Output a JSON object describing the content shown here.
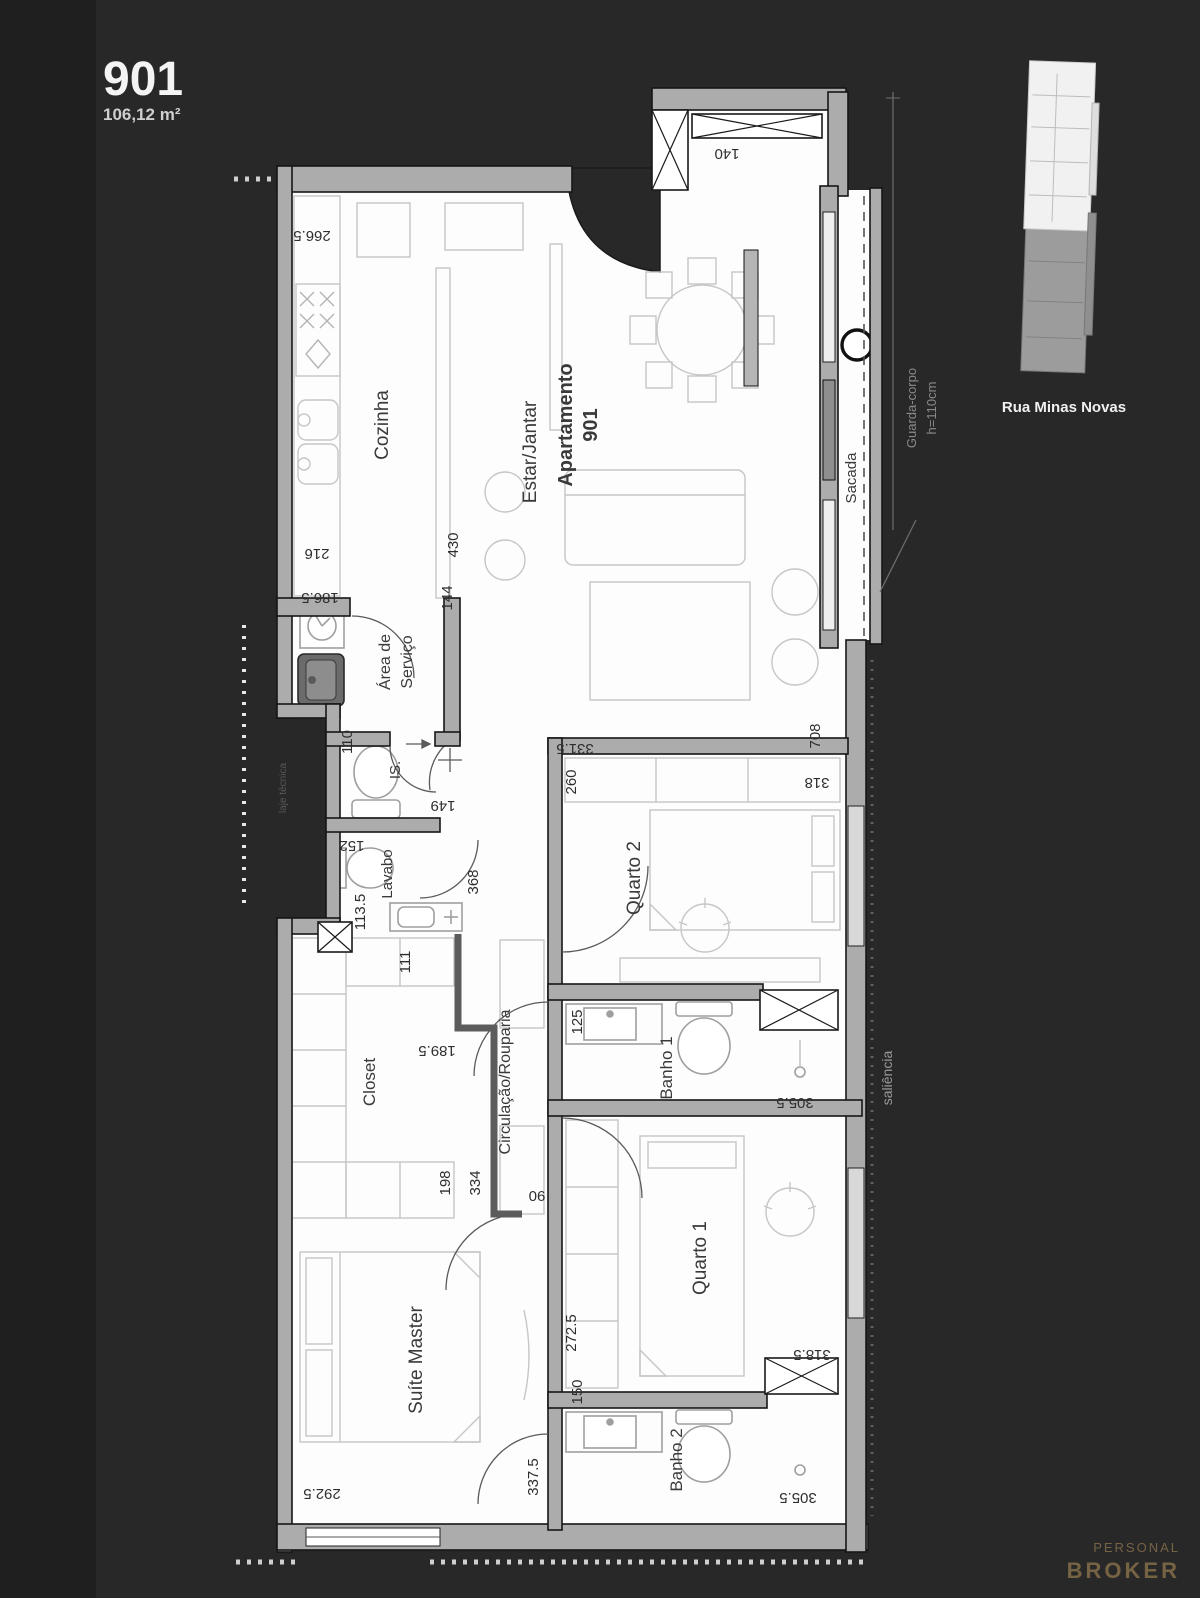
{
  "header": {
    "unit": "901",
    "area": "106,12 m²"
  },
  "minimap": {
    "street": "Rua Minas Novas"
  },
  "logo": {
    "line1": "PERSONAL",
    "line2": "BROKER"
  },
  "plan": {
    "rooms": {
      "cozinha": "Cozinha",
      "estar": "Estar/Jantar",
      "apto_l1": "Apartamento",
      "apto_l2": "901",
      "servico_l1": "Área de",
      "servico_l2": "Serviço",
      "is": "IS.",
      "lavabo": "Lavabo",
      "closet": "Closet",
      "circulacao": "Circulação/Rouparia",
      "quarto2": "Quarto 2",
      "banho1": "Banho 1",
      "quarto1": "Quarto 1",
      "banho2": "Banho 2",
      "suite": "Suíte Master",
      "sacada": "Sacada",
      "saliencia": "saliência",
      "guarda_l1": "Guarda-corpo",
      "guarda_l2": "h=110cm",
      "laje": "laje técnica"
    },
    "dims": {
      "d266_5": "266.5",
      "d140": "140",
      "d216": "216",
      "d186_5": "186.5",
      "d430": "430",
      "d144": "144",
      "d110": "110",
      "d149": "149",
      "d152": "152",
      "d113_5": "113.5",
      "d368": "368",
      "d111": "111",
      "d189_5": "189.5",
      "d198": "198",
      "d334": "334",
      "d90": "90",
      "d331_5": "331.5",
      "d260": "260",
      "d708": "708",
      "d318": "318",
      "d125": "125",
      "d305_5a": "305.5",
      "d272_5": "272.5",
      "d150": "150",
      "d318_5": "318.5",
      "d305_5b": "305.5",
      "d292_5": "292.5",
      "d337_5": "337.5"
    }
  },
  "colors": {
    "background": "#282828",
    "accent_gold": "#756344",
    "wall_gray": "#acacac",
    "plan_white": "#fdfdfd"
  }
}
